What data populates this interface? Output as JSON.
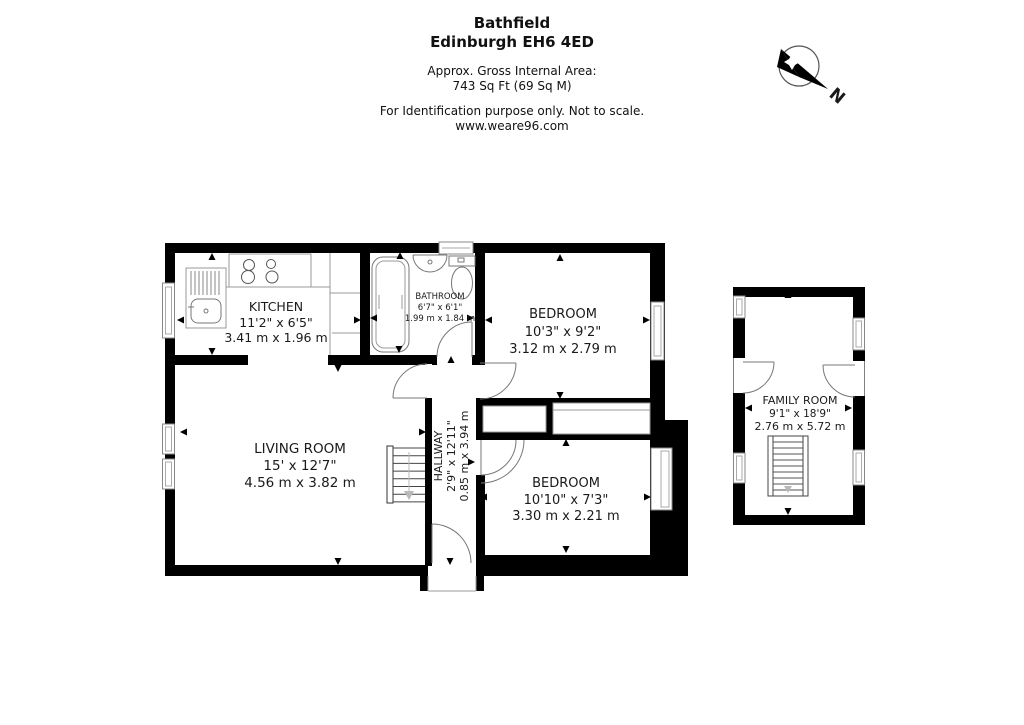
{
  "header": {
    "title_line1": "Bathfield",
    "title_line2": "Edinburgh EH6 4ED",
    "area_line1": "Approx. Gross Internal Area:",
    "area_line2": "743 Sq Ft (69 Sq M)",
    "disclaimer": "For Identification purpose only. Not to scale.",
    "website": "www.weare96.com"
  },
  "compass": {
    "north_label": "N"
  },
  "rooms": {
    "kitchen": {
      "name": "KITCHEN",
      "dims_imperial": "11'2\" x 6'5\"",
      "dims_metric": "3.41 m x 1.96 m"
    },
    "bathroom": {
      "name": "BATHROOM",
      "dims_imperial": "6'7\" x 6'1\"",
      "dims_metric": "1.99 m x 1.84 m"
    },
    "bedroom_top": {
      "name": "BEDROOM",
      "dims_imperial": "10'3\" x 9'2\"",
      "dims_metric": "3.12 m x 2.79 m"
    },
    "living_room": {
      "name": "LIVING ROOM",
      "dims_imperial": "15' x 12'7\"",
      "dims_metric": "4.56 m x 3.82 m"
    },
    "hallway": {
      "name": "HALLWAY",
      "dims_imperial": "2'9\" x 12'11\"",
      "dims_metric": "0.85 m x 3.94 m"
    },
    "bedroom_bottom": {
      "name": "BEDROOM",
      "dims_imperial": "10'10\" x 7'3\"",
      "dims_metric": "3.30 m x 2.21 m"
    },
    "family_room": {
      "name": "FAMILY ROOM",
      "dims_imperial": "9'1\" x 18'9\"",
      "dims_metric": "2.76 m x 5.72 m"
    }
  },
  "colors": {
    "wall": "#000000",
    "fixture": "#8a8a8a",
    "window_inner": "#aaaaaa"
  }
}
